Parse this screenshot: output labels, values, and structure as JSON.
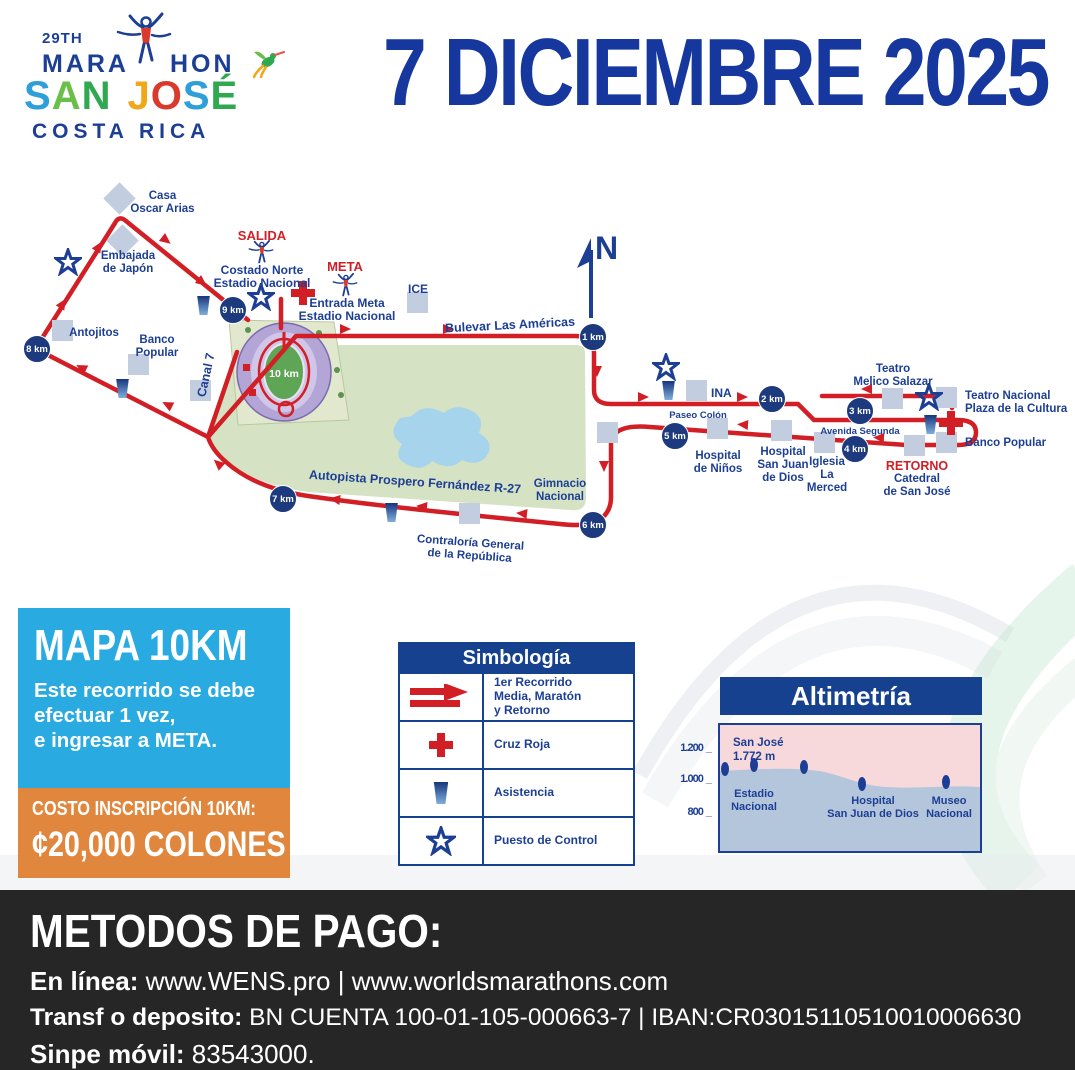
{
  "colors": {
    "navy": "#1C3E94",
    "title_navy": "#16389E",
    "route_red": "#D21F26",
    "badge_navy": "#1C3A7D",
    "park_green": "#D5E3C4",
    "lake_blue": "#A6D4EC",
    "box_blue": "#29ABE2",
    "box_orange": "#E0873D",
    "panel_navy": "#15418F",
    "footer_black": "#262626"
  },
  "logo": {
    "edition": "29TH",
    "word_left": "MARA",
    "word_right": "HON",
    "country": "COSTA RICA",
    "city_letters": [
      {
        "ch": "S",
        "color": "#2E9FD8"
      },
      {
        "ch": "A",
        "color": "#6ABF4B"
      },
      {
        "ch": "N",
        "color": "#2FA84F"
      },
      {
        "ch": "J",
        "color": "#F2A71B"
      },
      {
        "ch": "O",
        "color": "#D93A2B"
      },
      {
        "ch": "S",
        "color": "#2E9FD8"
      },
      {
        "ch": "É",
        "color": "#2FA84F"
      }
    ]
  },
  "header": {
    "date_title": "7 DICIEMBRE 2025"
  },
  "map": {
    "north_label": "N",
    "stadium_km": "10 km",
    "km_badges": [
      "1 km",
      "2 km",
      "3 km",
      "4 km",
      "5 km",
      "6 km",
      "7 km",
      "8 km",
      "9 km"
    ],
    "labels": {
      "casa_oscar_arias": "Casa\nOscar Arias",
      "embajada": "Embajada\nde Japón",
      "antojitos": "Antojitos",
      "banco_popular_left": "Banco\nPopular",
      "salida": "SALIDA",
      "costado_norte": "Costado Norte\nEstadio Nacional",
      "meta": "META",
      "entrada_meta": "Entrada Meta\nEstadio Nacional",
      "ice": "ICE",
      "bulevar": "Bulevar Las Américas",
      "canal7": "Canal 7",
      "ina": "INA",
      "paseo_colon": "Paseo Colón",
      "teatro_melico": "Teatro\nMelico Salazar",
      "teatro_nacional": "Teatro Nacional\nPlaza de la Cultura",
      "avenida_segunda": "Avenida Segunda",
      "banco_popular_right": "Banco Popular",
      "hospital_ninos": "Hospital\nde Niños",
      "hospital_sjd": "Hospital\nSan Juan\nde Dios",
      "iglesia_merced": "Iglesia\nLa\nMerced",
      "retorno": "RETORNO",
      "catedral": "Catedral\nde San José",
      "gimnasio": "Gimnacio\nNacional",
      "autopista": "Autopista Prospero Fernández R-27",
      "contraloria": "Contraloría General\nde la República"
    }
  },
  "info_box": {
    "title": "MAPA 10KM",
    "description": "Este recorrido se debe\nefectuar 1 vez,\ne ingresar a META."
  },
  "price_box": {
    "label": "COSTO INSCRIPCIÓN 10KM:",
    "price": "¢20,000 COLONES"
  },
  "simbologia": {
    "title": "Simbología",
    "rows": [
      {
        "icon": "route-arrow",
        "label": "1er Recorrido\nMedia, Maratón\ny Retorno"
      },
      {
        "icon": "red-cross",
        "label": "Cruz Roja"
      },
      {
        "icon": "assistance-cone",
        "label": "Asistencia"
      },
      {
        "icon": "control-star",
        "label": "Puesto de Control"
      }
    ]
  },
  "altimetria": {
    "title": "Altimetría",
    "y_ticks": [
      "1.200",
      "1.000",
      "800"
    ],
    "annotation": "San José\n1.772 m",
    "x_labels": [
      "Estadio\nNacional",
      "Hospital\nSan Juan de Dios",
      "Museo\nNacional"
    ]
  },
  "chart_data": {
    "type": "area",
    "title": "Altimetría",
    "ylabel": "Elevación (m)",
    "ylim": [
      600,
      1300
    ],
    "y_ticks": [
      800,
      1000,
      1200
    ],
    "grid": false,
    "annotation": "San José 1.772 m",
    "x_labels": [
      "Estadio Nacional",
      "Hospital San Juan de Dios",
      "Museo Nacional"
    ],
    "points": [
      {
        "x_km": 0,
        "elevation_m": 1040
      },
      {
        "x_km": 2,
        "elevation_m": 1050
      },
      {
        "x_km": 4,
        "elevation_m": 1045
      },
      {
        "x_km": 6.5,
        "elevation_m": 995
      },
      {
        "x_km": 9,
        "elevation_m": 1005
      }
    ]
  },
  "payment": {
    "title": "METODOS DE PAGO:",
    "lines": [
      {
        "label": "En línea:",
        "value": " www.WENS.pro | www.worldsmarathons.com"
      },
      {
        "label": "Transf o deposito:",
        "value": " BN CUENTA 100-01-105-000663-7  |  IBAN:CR03015110510010006630"
      },
      {
        "label": "Sinpe móvil:",
        "value": " 83543000."
      }
    ]
  }
}
